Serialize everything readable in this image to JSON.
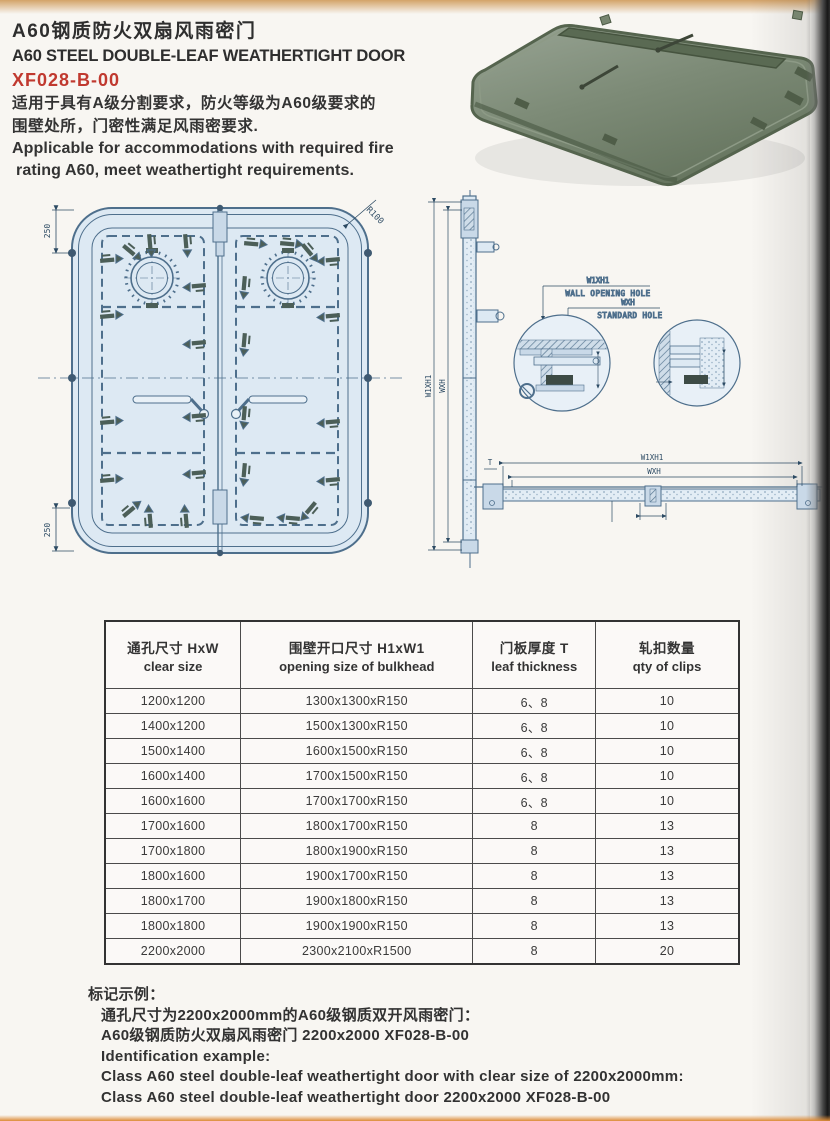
{
  "header": {
    "title_zh": "A60钢质防火双扇风雨密门",
    "title_en": "A60 STEEL DOUBLE-LEAF WEATHERTIGHT DOOR",
    "model": "XF028-B-00",
    "desc_zh_line1": "适用于具有A级分割要求，防火等级为A60级要求的",
    "desc_zh_line2": "围壁处所，门密性满足风雨密要求.",
    "desc_en_line1": "Applicable for accommodations with required fire",
    "desc_en_line2": "rating A60, meet weathertight requirements."
  },
  "drawings": {
    "front": {
      "dim_top": "250",
      "dim_bottom": "250",
      "dim_radius": "R100"
    },
    "side": {
      "dim_outer": "W1XH1",
      "dim_inner": "WXH"
    },
    "details": {
      "label1": "W1XH1",
      "label1_sub": "WALL OPENING HOLE",
      "label2": "WXH",
      "label2_sub": "STANDARD HOLE"
    },
    "section": {
      "dim_outer": "W1XH1",
      "dim_inner": "WXH",
      "dim_thickness": "T"
    }
  },
  "table": {
    "headers": [
      {
        "zh": "通孔尺寸 HxW",
        "en": "clear size"
      },
      {
        "zh": "围壁开口尺寸 H1xW1",
        "en": "opening size of bulkhead"
      },
      {
        "zh": "门板厚度 T",
        "en": "leaf thickness"
      },
      {
        "zh": "轧扣数量",
        "en": "qty of clips"
      }
    ],
    "rows": [
      [
        "1200x1200",
        "1300x1300xR150",
        "6、8",
        "10"
      ],
      [
        "1400x1200",
        "1500x1300xR150",
        "6、8",
        "10"
      ],
      [
        "1500x1400",
        "1600x1500xR150",
        "6、8",
        "10"
      ],
      [
        "1600x1400",
        "1700x1500xR150",
        "6、8",
        "10"
      ],
      [
        "1600x1600",
        "1700x1700xR150",
        "6、8",
        "10"
      ],
      [
        "1700x1600",
        "1800x1700xR150",
        "8",
        "13"
      ],
      [
        "1700x1800",
        "1800x1900xR150",
        "8",
        "13"
      ],
      [
        "1800x1600",
        "1900x1700xR150",
        "8",
        "13"
      ],
      [
        "1800x1700",
        "1900x1800xR150",
        "8",
        "13"
      ],
      [
        "1800x1800",
        "1900x1900xR150",
        "8",
        "13"
      ],
      [
        "2200x2000",
        "2300x2100xR1500",
        "8",
        "20"
      ]
    ]
  },
  "footer": {
    "lines": [
      "标记示例：",
      "通孔尺寸为2200x2000mm的A60级钢质双开风雨密门：",
      "A60级钢质防火双扇风雨密门 2200x2000 XF028-B-00",
      "Identification example:",
      "Class A60 steel double-leaf weathertight door with clear size of 2200x2000mm:",
      "Class A60 steel double-leaf weathertight door 2200x2000 XF028-B-00"
    ]
  },
  "colors": {
    "accent_red": "#c0392f",
    "line_blue": "#4e6f8c",
    "fill_blue": "#dde9f3",
    "door_green": "#7c8a74"
  }
}
